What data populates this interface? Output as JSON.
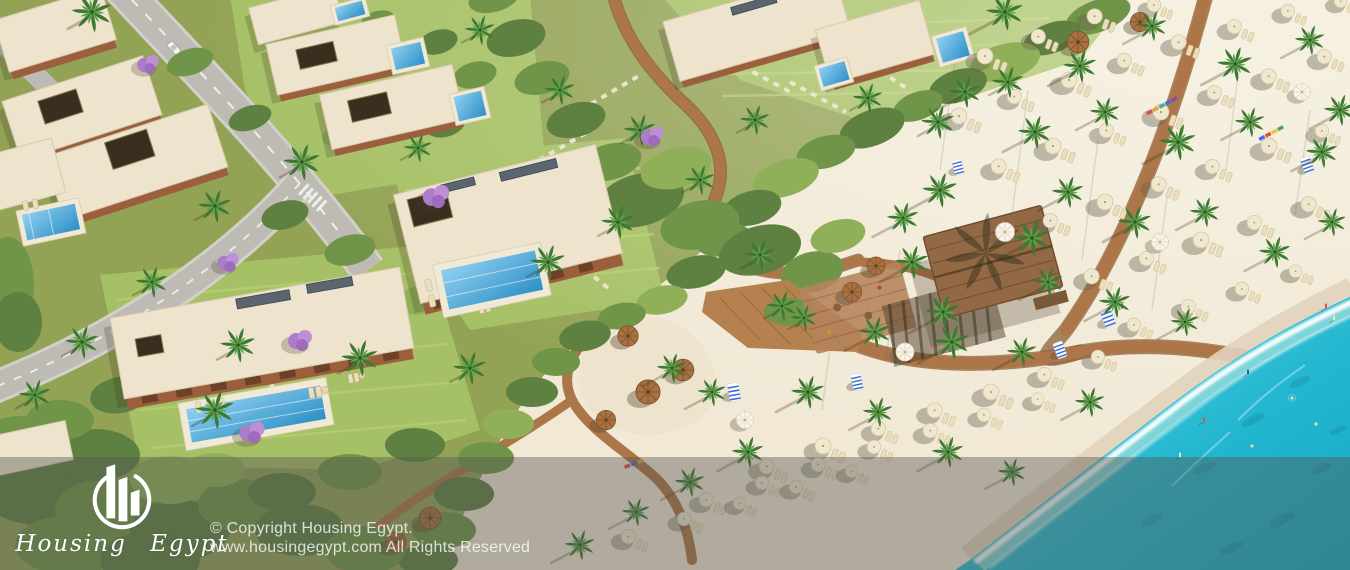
{
  "watermark": {
    "logo_text": "Housing Egypt",
    "copyright_line1": "© Copyright Housing Egypt.",
    "copyright_line2": "www.housingegypt.com All Rights Reserved"
  },
  "scene": {
    "type": "aerial-3d-render",
    "subject": "Beachfront resort masterplan: flat-roof villas with private pools, roads and gardens at top left, winding timber boardwalks through landscaped dunes, white-sand beach with palms, sun umbrellas, loungers and a thatched beach bar, turquoise sea at bottom right",
    "palette": {
      "sand": "#f1e9d6",
      "inland": "#93a356",
      "lawn": "#a6c065",
      "shrub_dark": "#5e8040",
      "shrub": "#719548",
      "shrub_light": "#8fb058",
      "road": "#bdbbb3",
      "path": "#ad7648",
      "roof": "#eee3cc",
      "facade": "#9b5f3d",
      "pool": "#2e8fc6",
      "sea_deep": "#14a9c6",
      "sea_shallow": "#8fe0da",
      "foam": "#ffffff",
      "palm": "#3c7a32",
      "thatch": "#a9713f",
      "jacaranda": "#b487cf",
      "overlay": "rgba(85,85,82,0.42)",
      "watermark_text": "#ffffff"
    }
  }
}
